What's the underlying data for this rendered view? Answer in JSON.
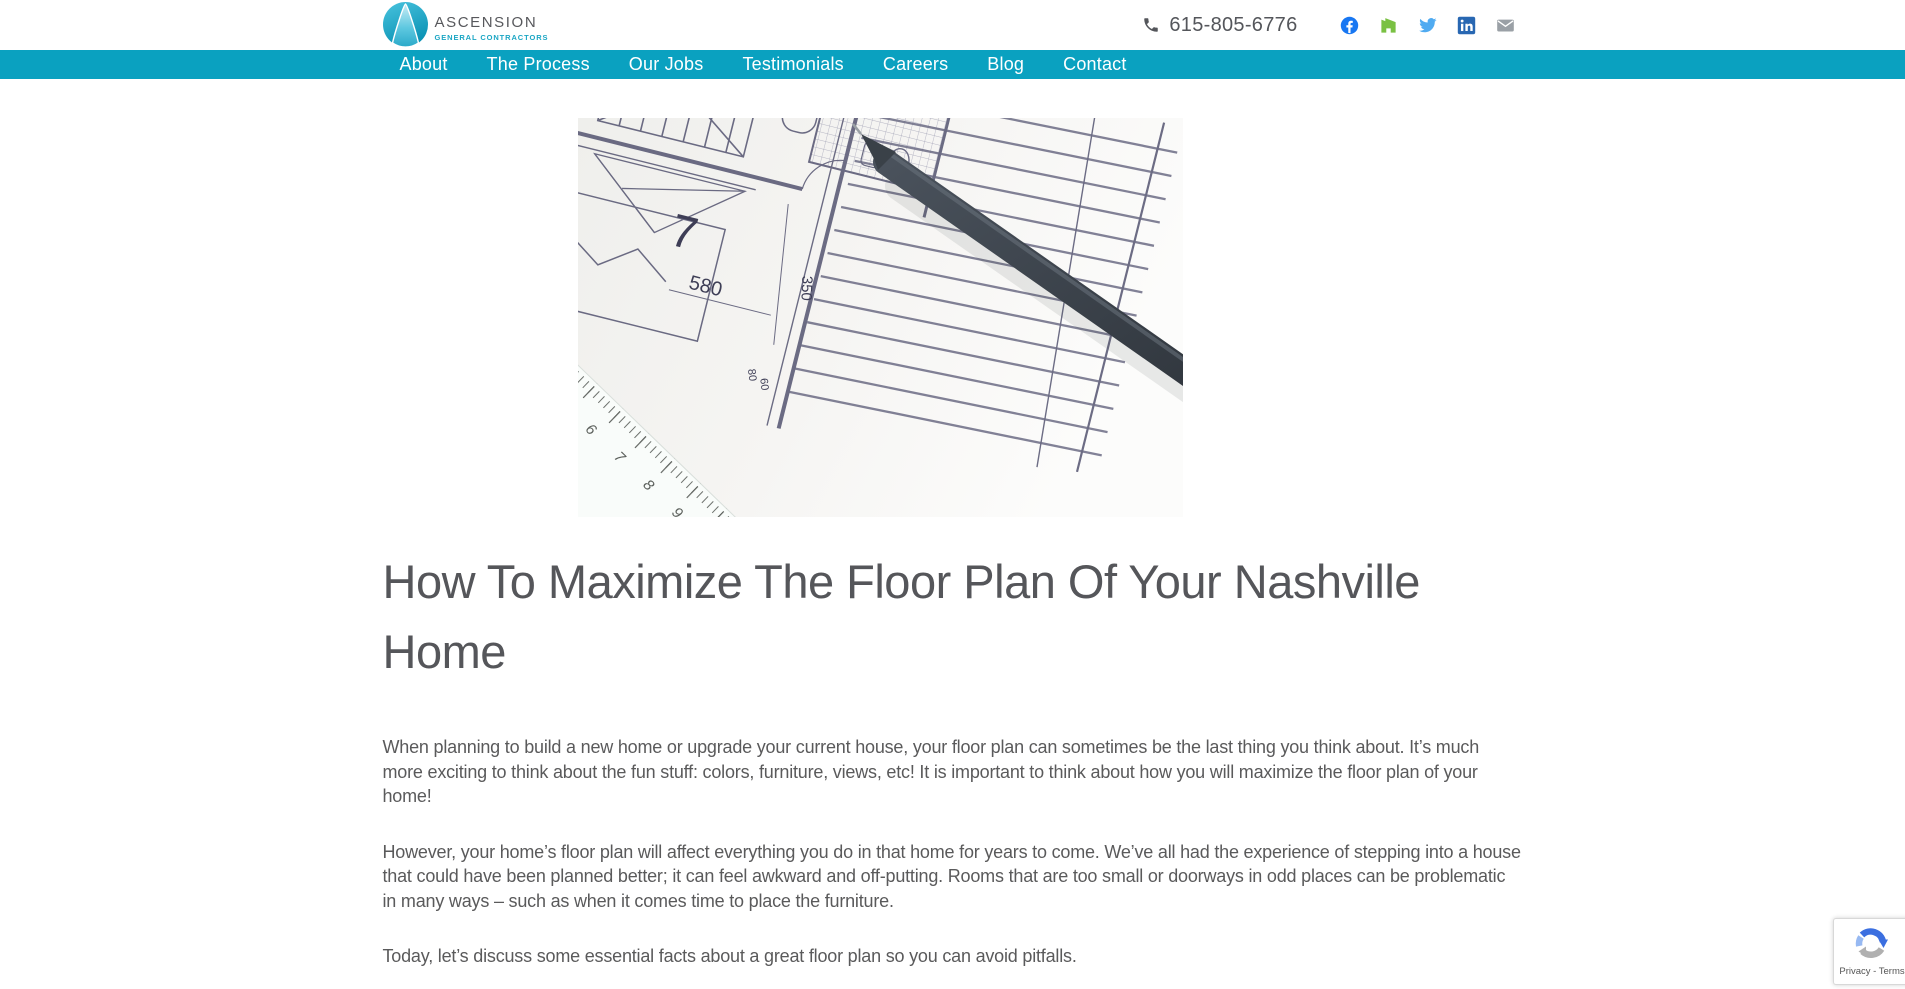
{
  "theme": {
    "teal": "#0aa1c0",
    "heading_gray": "#55565a",
    "body_gray": "#5a5a5b"
  },
  "brand": {
    "name": "ASCENSION",
    "tagline": "GENERAL CONTRACTORS",
    "phone": "615-805-6776"
  },
  "social": {
    "facebook_color": "#1877f2",
    "houzz_color": "#7ac143",
    "twitter_color": "#50abf1",
    "linkedin_color": "#2867b2",
    "email_color": "#9aa0a6"
  },
  "nav": {
    "items": [
      "About",
      "The Process",
      "Our Jobs",
      "Testimonials",
      "Careers",
      "Blog",
      "Contact"
    ]
  },
  "article": {
    "title": "How To Maximize The Floor Plan Of Your Nashville Home",
    "paragraphs": [
      "When planning to build a new home or upgrade your current house, your floor plan can sometimes be the last thing you think about. It’s much more exciting to think about the fun stuff: colors, furniture, views, etc! It is important to think about how you will maximize the floor plan of your home!",
      "However, your home’s floor plan will affect everything you do in that home for years to come. We’ve all had the experience of stepping into a house that could have been planned better; it can feel awkward and off-putting. Rooms that are too small or doorways in odd places can be problematic in many ways – such as when it comes time to place the furniture.",
      "Today, let’s discuss some essential facts about a great floor plan so you can avoid pitfalls."
    ]
  },
  "hero": {
    "plan_labels": {
      "room_number": "7",
      "dim_width": "580",
      "dim_height": "350",
      "dim_small_a": "80",
      "dim_small_b": "60"
    },
    "ruler_numbers": [
      "5",
      "6",
      "7",
      "8",
      "9"
    ]
  },
  "recaptcha": {
    "privacy_terms": "Privacy - Terms"
  }
}
